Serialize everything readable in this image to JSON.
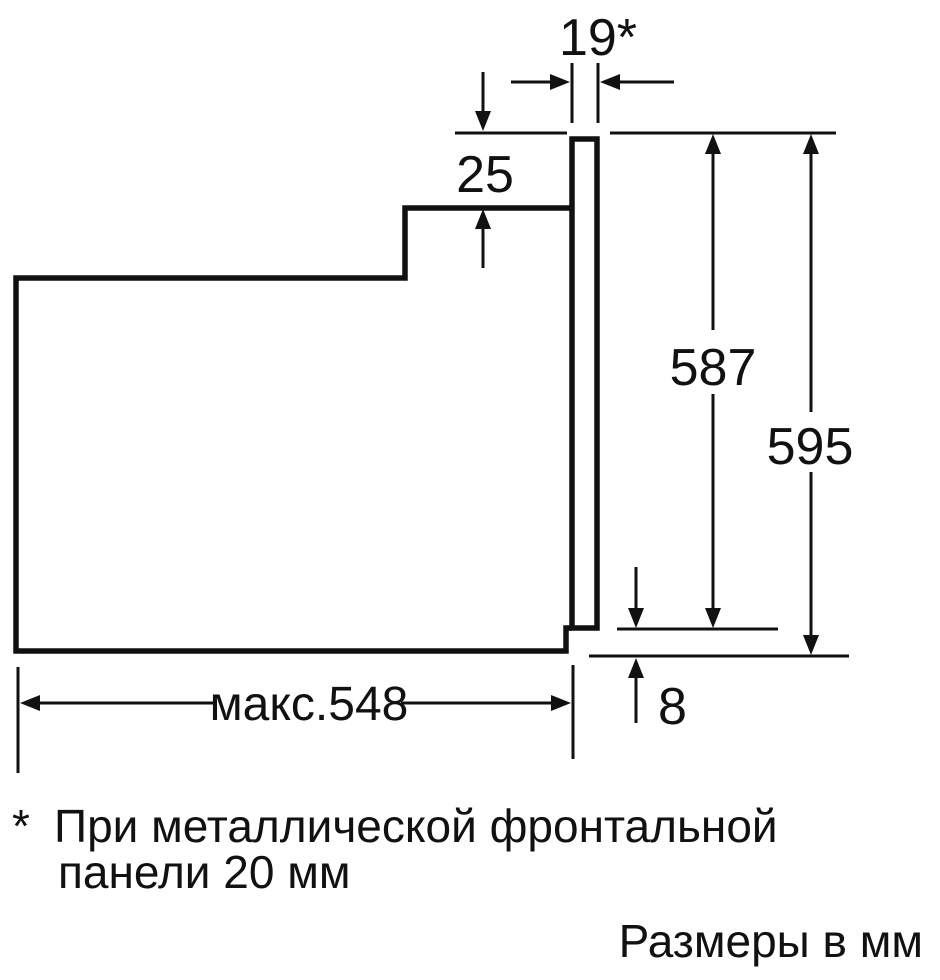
{
  "dims": {
    "front_gap": "19*",
    "top_clearance": "25",
    "case_height": "587",
    "total_height": "595",
    "bottom_inset": "8",
    "max_depth": "макс.548"
  },
  "footnote": {
    "marker": "*",
    "line1": "При металлической фронтальной",
    "line2": "панели 20 мм"
  },
  "units_caption": "Размеры в мм",
  "colors": {
    "background": "#ffffff",
    "line": "#111111",
    "text": "#111111"
  }
}
